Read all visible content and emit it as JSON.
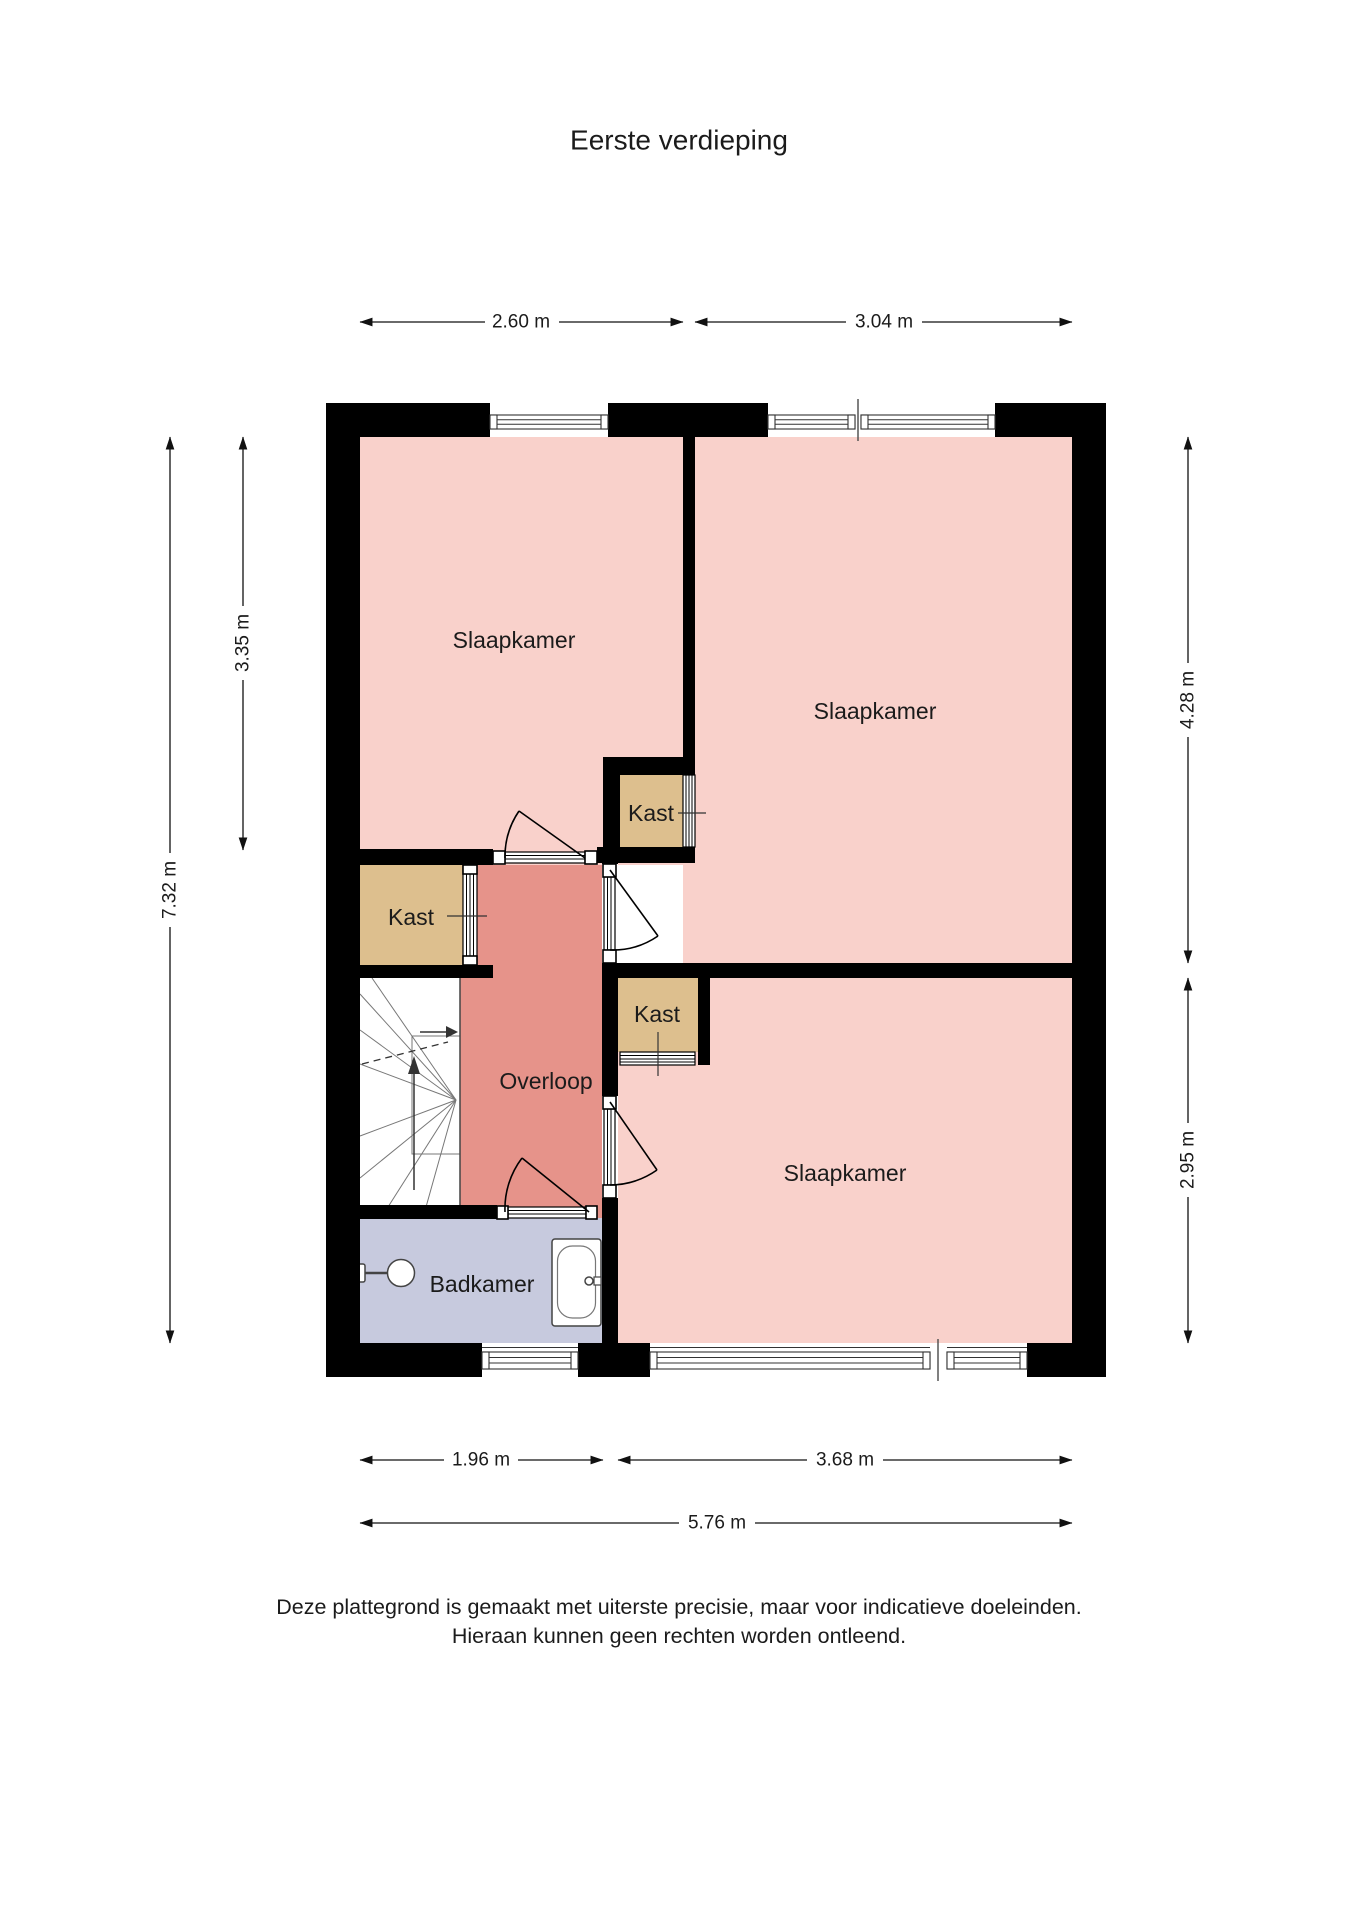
{
  "title": "Eerste verdieping",
  "rooms": {
    "bedroom1": "Slaapkamer",
    "bedroom2": "Slaapkamer",
    "bedroom3": "Slaapkamer",
    "landing": "Overloop",
    "bathroom": "Badkamer",
    "closet1": "Kast",
    "closet2": "Kast",
    "closet3": "Kast"
  },
  "dimensions": {
    "top": [
      "2.60 m",
      "3.04 m"
    ],
    "left": [
      "3.35 m",
      "7.32 m"
    ],
    "right": [
      "4.28 m",
      "2.95 m"
    ],
    "bottom": [
      "1.96 m",
      "3.68 m"
    ],
    "total": "5.76 m"
  },
  "disclaimer": [
    "Deze plattegrond is gemaakt met uiterste precisie, maar voor indicatieve doeleinden.",
    "Hieraan kunnen geen rechten worden ontleend."
  ],
  "colors": {
    "wall": "#000000",
    "bedroom": "#f9d1cb",
    "landing": "#e6938a",
    "closet": "#ddbf8e",
    "bathroom": "#c7cade",
    "stairs": "#ffffff"
  }
}
